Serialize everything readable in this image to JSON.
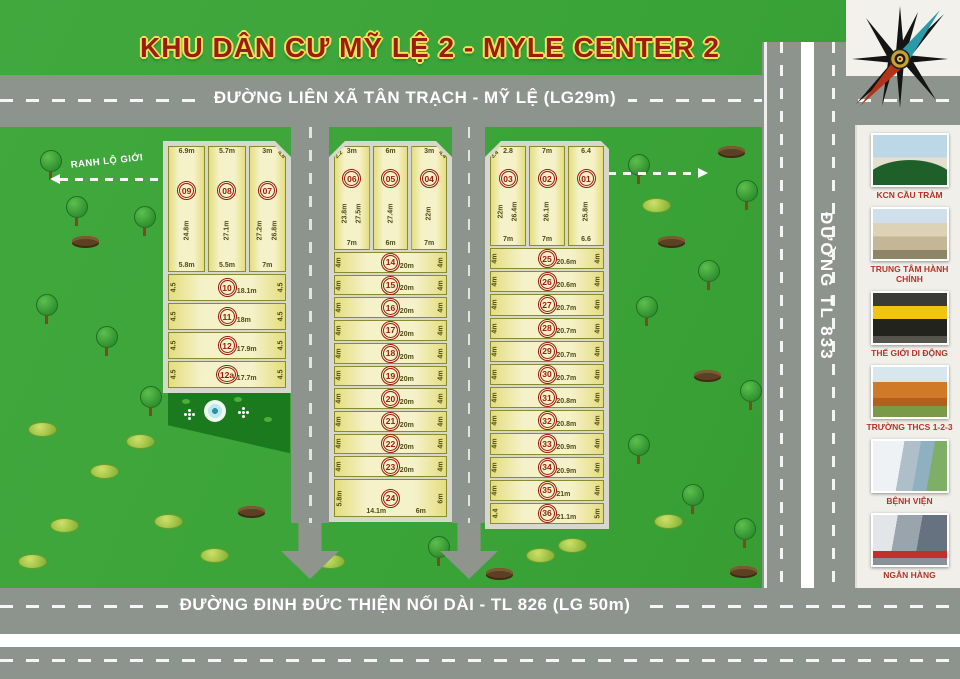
{
  "title": "KHU DÂN CƯ MỸ LỆ 2 - MYLE CENTER 2",
  "roads": {
    "top": "ĐƯỜNG LIÊN XÃ TÂN TRẠCH - MỸ LỆ (LG29m)",
    "bottom": "ĐƯỜNG ĐINH ĐỨC THIỆN NỐI DÀI - TL 826 (LG 50m)",
    "right_vertical": "ĐƯỜNG TL 833"
  },
  "boundary": {
    "label": "RANH LỘ GIỚI"
  },
  "colors": {
    "accent_red": "#9c1d10",
    "banner_outline": "#f2e35c",
    "road_gray": "#8d938d",
    "plot_fill": "#f5f1c8",
    "plot_edge": "#8a8a2e",
    "sidewalk": "#d7d8cc",
    "background_green": "#3aa337",
    "park_green": "#1c7a1e",
    "label_red": "#b5342a"
  },
  "landmarks": [
    {
      "name": "KCN CẦU TRÀM",
      "photo": "industrial-gate"
    },
    {
      "name": "TRUNG TÂM HÀNH CHÍNH",
      "photo": "government-center"
    },
    {
      "name": "THẾ GIỚI DI ĐỘNG",
      "photo": "mobile-store"
    },
    {
      "name": "TRƯỜNG THCS 1-2-3",
      "photo": "school"
    },
    {
      "name": "BỆNH VIỆN",
      "photo": "hospital"
    },
    {
      "name": "NGÂN HÀNG",
      "photo": "bank"
    }
  ],
  "blocks": {
    "left": {
      "vertical": [
        {
          "no": "09",
          "top": "6.9m",
          "sides": [
            "24.8m"
          ],
          "bottom": "5.8m"
        },
        {
          "no": "08",
          "top": "5.7m",
          "sides": [
            "27.1m"
          ],
          "bottom": "5.5m"
        },
        {
          "no": "07",
          "top": "3m",
          "corner": "4.8",
          "cut": "right",
          "sides": [
            "27.2m",
            "26.8m"
          ],
          "bottom": "7m"
        }
      ],
      "rows": [
        {
          "no": "10",
          "left": "4.5",
          "width": "18.1m",
          "right": "4.5"
        },
        {
          "no": "11",
          "left": "4.5",
          "width": "18m",
          "right": "4.5"
        },
        {
          "no": "12",
          "left": "4.5",
          "width": "17.9m",
          "right": "4.5"
        },
        {
          "no": "12a",
          "left": "4.5",
          "width": "17.7m",
          "right": "4.5"
        }
      ]
    },
    "middle": {
      "vertical": [
        {
          "no": "06",
          "top": "3m",
          "corner": "2.2",
          "cut": "left",
          "sides": [
            "23.8m",
            "27.5m"
          ],
          "bottom": "7m"
        },
        {
          "no": "05",
          "top": "6m",
          "sides": [
            "27.4m"
          ],
          "bottom": "6m"
        },
        {
          "no": "04",
          "top": "3m",
          "corner": "4.4",
          "cut": "right",
          "sides": [
            "22m"
          ],
          "bottom": "7m"
        }
      ],
      "rows": [
        {
          "no": "14",
          "left": "4m",
          "width": "20m",
          "right": "4m"
        },
        {
          "no": "15",
          "left": "4m",
          "width": "20m",
          "right": "4m"
        },
        {
          "no": "16",
          "left": "4m",
          "width": "20m",
          "right": "4m"
        },
        {
          "no": "17",
          "left": "4m",
          "width": "20m",
          "right": "4m"
        },
        {
          "no": "18",
          "left": "4m",
          "width": "20m",
          "right": "4m"
        },
        {
          "no": "19",
          "left": "4m",
          "width": "20m",
          "right": "4m"
        },
        {
          "no": "20",
          "left": "4m",
          "width": "20m",
          "right": "4m"
        },
        {
          "no": "21",
          "left": "4m",
          "width": "20m",
          "right": "4m"
        },
        {
          "no": "22",
          "left": "4m",
          "width": "20m",
          "right": "4m"
        },
        {
          "no": "23",
          "left": "4m",
          "width": "20m",
          "right": "4m"
        }
      ],
      "big_plot": {
        "no": "24",
        "left": "5.8m",
        "width": "14.1m",
        "width2": "6m",
        "right": "6m"
      }
    },
    "right": {
      "vertical": [
        {
          "no": "03",
          "top": "2.8",
          "corner": "3.4",
          "cut": "left",
          "sides": [
            "22m",
            "26.4m"
          ],
          "bottom": "7m"
        },
        {
          "no": "02",
          "top": "7m",
          "sides": [
            "26.1m"
          ],
          "bottom": "7m"
        },
        {
          "no": "01",
          "top": "6.4",
          "sides": [
            "25.8m"
          ],
          "bottom": "6.6"
        }
      ],
      "rows": [
        {
          "no": "25",
          "left": "4m",
          "width": "20.6m",
          "right": "4m"
        },
        {
          "no": "26",
          "left": "4m",
          "width": "20.6m",
          "right": "4m"
        },
        {
          "no": "27",
          "left": "4m",
          "width": "20.7m",
          "right": "4m"
        },
        {
          "no": "28",
          "left": "4m",
          "width": "20.7m",
          "right": "4m"
        },
        {
          "no": "29",
          "left": "4m",
          "width": "20.7m",
          "right": "4m"
        },
        {
          "no": "30",
          "left": "4m",
          "width": "20.7m",
          "right": "4m"
        },
        {
          "no": "31",
          "left": "4m",
          "width": "20.8m",
          "right": "4m"
        },
        {
          "no": "32",
          "left": "4m",
          "width": "20.8m",
          "right": "4m"
        },
        {
          "no": "33",
          "left": "4m",
          "width": "20.9m",
          "right": "4m"
        },
        {
          "no": "34",
          "left": "4m",
          "width": "20.9m",
          "right": "4m"
        },
        {
          "no": "35",
          "left": "4m",
          "width": "21m",
          "right": "4m"
        },
        {
          "no": "36",
          "left": "4.4",
          "width": "21.1m",
          "right": "5m"
        }
      ]
    }
  }
}
